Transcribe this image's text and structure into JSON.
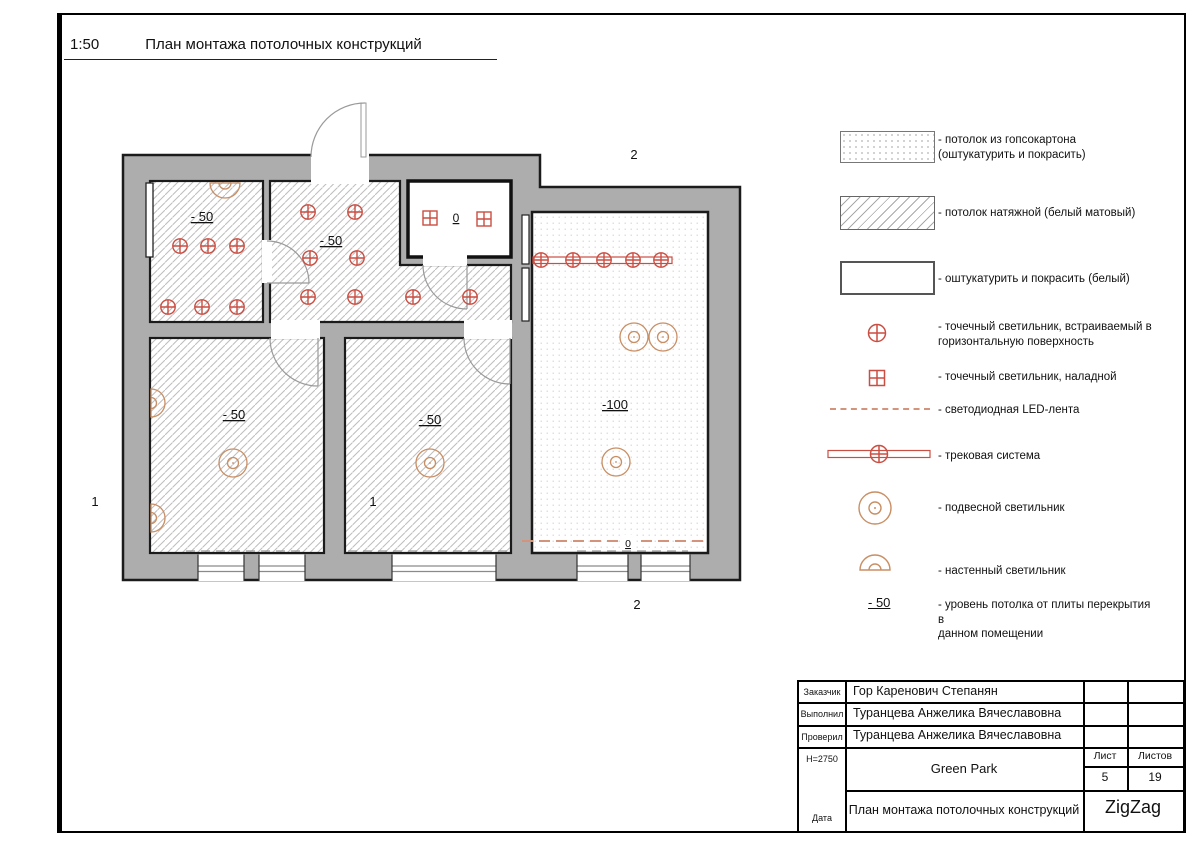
{
  "sheet": {
    "scale": "1:50",
    "title": "План монтажа потолочных конструкций"
  },
  "plan": {
    "room_top_left_level": "- 50",
    "hallway_level": "- 50",
    "bathroom_level": "0",
    "room_bottom_left_level": "- 50",
    "room_bottom_middle_level": "- 50",
    "living_room_level": "-100",
    "led_level": "0",
    "axis_1_left": "1",
    "axis_1_inner": "1",
    "axis_2_top": "2",
    "axis_2_bottom": "2"
  },
  "legend": {
    "items": [
      {
        "icon": "hatch-dots-swatch",
        "label": "- потолок из гопсокартона\n(оштукатурить и покрасить)"
      },
      {
        "icon": "hatch-diagonal-swatch",
        "label": "- потолок натяжной (белый матовый)"
      },
      {
        "icon": "plain-swatch",
        "label": "- оштукатурить и покрасить (белый)"
      },
      {
        "icon": "recessed-spotlight-icon",
        "label": "- точечный светильник, встраиваемый в\nгоризонтальную поверхность"
      },
      {
        "icon": "surface-spotlight-icon",
        "label": "- точечный светильник, наладной"
      },
      {
        "icon": "led-strip-icon",
        "label": "- светодиодная LED-лента"
      },
      {
        "icon": "track-system-icon",
        "label": "- трековая система"
      },
      {
        "icon": "pendant-light-icon",
        "label": "- подвесной светильник"
      },
      {
        "icon": "wall-light-icon",
        "label": "- настенный светильник"
      },
      {
        "icon": "level-mark",
        "mark": "- 50",
        "label": "- уровень потолка от плиты перекрытия в\nданном помещении"
      }
    ]
  },
  "titleblock": {
    "rows": [
      {
        "label": "Заказчик",
        "value": "Гор Каренович Степанян"
      },
      {
        "label": "Выполнил",
        "value": "Туранцева Анжелика Вячеславовна"
      },
      {
        "label": "Проверил",
        "value": "Туранцева Анжелика Вячеславовна"
      }
    ],
    "height_mark": "Н=2750",
    "date_label": "Дата",
    "project": "Green Park",
    "sheet_label": "Лист",
    "sheet_number": "5",
    "sheets_label": "Листов",
    "sheets_total": "19",
    "drawing_title": "План монтажа потолочных конструкций",
    "company": "ZigZag"
  },
  "colors": {
    "wall_fill": "#adadad",
    "outline": "#1b1b1b",
    "spot_red": "#cb4e42",
    "pendant_orange": "#c98e63",
    "led_orange": "#d4947c"
  }
}
